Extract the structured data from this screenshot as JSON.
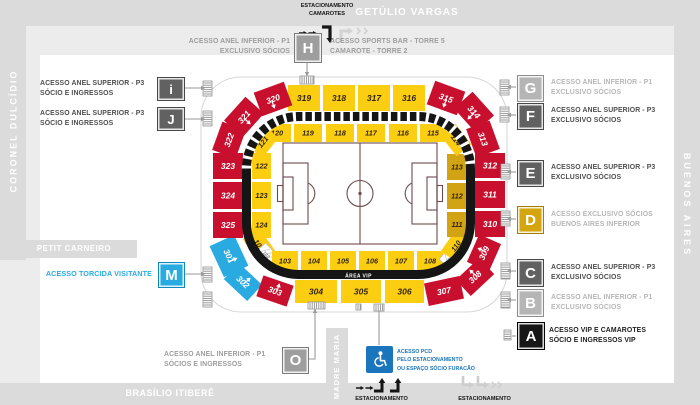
{
  "streets": {
    "top": "GETÚLIO VARGAS",
    "left": "CORONEL DULCÍDIO",
    "right": "BUENOS AIRES",
    "bottom": "BRASÍLIO ITIBERÊ",
    "petit": "PETIT CARNEIRO",
    "madre": "MADRE MARIA"
  },
  "parking": {
    "top": [
      "ESTACIONAMENTO",
      "CAMAROTES"
    ],
    "bottom_left": "ESTACIONAMENTO",
    "bottom_right": "ESTACIONAMENTO"
  },
  "accesses": [
    {
      "letter": "H",
      "label": [
        "ACESSO ANEL INFERIOR - P1",
        "EXCLUSIVO SÓCIOS"
      ],
      "label2": [
        "ACESSO SPORTS BAR - TORRE 5",
        "CAMAROTE - TORRE 2"
      ]
    },
    {
      "letter": "i",
      "label": [
        "ACESSO ANEL SUPERIOR - P3",
        "SÓCIO E INGRESSOS"
      ]
    },
    {
      "letter": "J",
      "label": [
        "ACESSO ANEL SUPERIOR - P3",
        "SÓCIO E INGRESSOS"
      ]
    },
    {
      "letter": "G",
      "label": [
        "ACESSO ANEL INFERIOR - P1",
        "EXCLUSIVO SÓCIOS"
      ]
    },
    {
      "letter": "F",
      "label": [
        "ACESSO ANEL SUPERIOR - P3",
        "EXCLUSIVO SÓCIOS"
      ]
    },
    {
      "letter": "E",
      "label": [
        "ACESSO ANEL SUPERIOR - P3",
        "EXCLUSIVO SÓCIOS"
      ]
    },
    {
      "letter": "D",
      "label": [
        "ACESSO EXCLUSIVO SÓCIOS",
        "BUENOS AIRES INFERIOR"
      ]
    },
    {
      "letter": "C",
      "label": [
        "ACESSO ANEL SUPERIOR - P3",
        "EXCLUSIVO SÓCIOS"
      ]
    },
    {
      "letter": "B",
      "label": [
        "ACESSO ANEL INFERIOR - P1",
        "EXCLUSIVO SÓCIOS"
      ]
    },
    {
      "letter": "A",
      "label": [
        "ACESSO VIP E CAMAROTES",
        "SÓCIO E INGRESSOS VIP"
      ]
    },
    {
      "letter": "M",
      "label": [
        "ACESSO TORCIDA VISITANTE"
      ]
    },
    {
      "letter": "O",
      "label": [
        "ACESSO ANEL INFERIOR - P1",
        "SÓCIOS E INGRESSOS"
      ]
    }
  ],
  "pcd": {
    "label": [
      "ACESSO PCD",
      "PELO ESTACIONAMENTO",
      "OU ESPAÇO SÓCIO FURACÃO"
    ]
  },
  "colors": {
    "red": "#c8102e",
    "yellow": "#fcce12",
    "gold": "#d2a312",
    "blue": "#29abe2",
    "band": "#151515",
    "field_line": "#6e4c4c",
    "pcd_blue": "#1b75bc",
    "accent_blue": "#29abe2"
  },
  "stadium": {
    "area_vip": "ÁREA VIP",
    "sections": [
      {
        "id": "301",
        "color": "blue"
      },
      {
        "id": "302",
        "color": "blue"
      },
      {
        "id": "303",
        "color": "red"
      },
      {
        "id": "304",
        "color": "yellow"
      },
      {
        "id": "305",
        "color": "yellow"
      },
      {
        "id": "306",
        "color": "yellow"
      },
      {
        "id": "307",
        "color": "red"
      },
      {
        "id": "308",
        "color": "red"
      },
      {
        "id": "309",
        "color": "red"
      },
      {
        "id": "310",
        "color": "red"
      },
      {
        "id": "311",
        "color": "red"
      },
      {
        "id": "312",
        "color": "red"
      },
      {
        "id": "313",
        "color": "red"
      },
      {
        "id": "314",
        "color": "red"
      },
      {
        "id": "315",
        "color": "red"
      },
      {
        "id": "316",
        "color": "yellow"
      },
      {
        "id": "317",
        "color": "yellow"
      },
      {
        "id": "318",
        "color": "yellow"
      },
      {
        "id": "319",
        "color": "yellow"
      },
      {
        "id": "320",
        "color": "red"
      },
      {
        "id": "321",
        "color": "red"
      },
      {
        "id": "322",
        "color": "red"
      },
      {
        "id": "323",
        "color": "red"
      },
      {
        "id": "324",
        "color": "red"
      },
      {
        "id": "325",
        "color": "red"
      },
      {
        "id": "101",
        "color": "yellow"
      },
      {
        "id": "102",
        "color": "hatch"
      },
      {
        "id": "103",
        "color": "yellow"
      },
      {
        "id": "104",
        "color": "yellow"
      },
      {
        "id": "105",
        "color": "yellow"
      },
      {
        "id": "106",
        "color": "yellow"
      },
      {
        "id": "107",
        "color": "yellow"
      },
      {
        "id": "108",
        "color": "yellow"
      },
      {
        "id": "109",
        "color": "hatch"
      },
      {
        "id": "110",
        "color": "yellow"
      },
      {
        "id": "111",
        "color": "gold"
      },
      {
        "id": "112",
        "color": "gold"
      },
      {
        "id": "113",
        "color": "gold"
      },
      {
        "id": "114",
        "color": "yellow"
      },
      {
        "id": "115",
        "color": "yellow"
      },
      {
        "id": "116",
        "color": "yellow"
      },
      {
        "id": "117",
        "color": "yellow"
      },
      {
        "id": "118",
        "color": "yellow"
      },
      {
        "id": "119",
        "color": "yellow"
      },
      {
        "id": "120",
        "color": "yellow"
      },
      {
        "id": "121",
        "color": "yellow"
      },
      {
        "id": "122",
        "color": "yellow"
      },
      {
        "id": "123",
        "color": "yellow"
      },
      {
        "id": "124",
        "color": "yellow"
      }
    ]
  }
}
